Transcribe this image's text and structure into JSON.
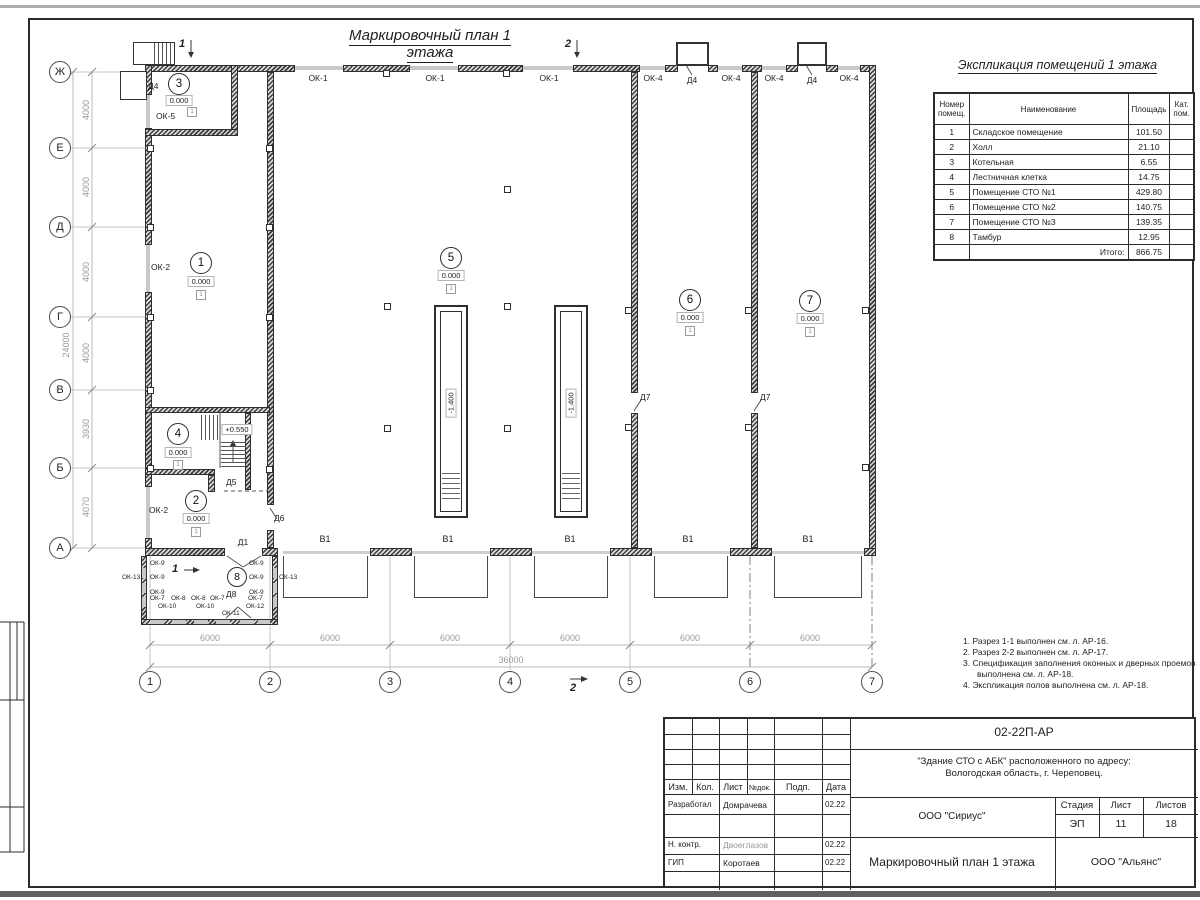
{
  "page": {
    "plan_title": "Маркировочный план 1 этажа",
    "table_title": "Экспликация помещений 1 этажа"
  },
  "table": {
    "col_num": "Номер помещ.",
    "col_name": "Наименование",
    "col_area": "Площадь",
    "col_cat": "Кат. пом.",
    "rows": [
      {
        "num": "1",
        "name": "Складское помещение",
        "area": "101.50"
      },
      {
        "num": "2",
        "name": "Холл",
        "area": "21.10"
      },
      {
        "num": "3",
        "name": "Котельная",
        "area": "6.55"
      },
      {
        "num": "4",
        "name": "Лестничная клетка",
        "area": "14.75"
      },
      {
        "num": "5",
        "name": "Помещение СТО №1",
        "area": "429.80"
      },
      {
        "num": "6",
        "name": "Помещение СТО №2",
        "area": "140.75"
      },
      {
        "num": "7",
        "name": "Помещение СТО №3",
        "area": "139.35"
      },
      {
        "num": "8",
        "name": "Тамбур",
        "area": "12.95"
      }
    ],
    "total_label": "Итого:",
    "total_area": "866.75"
  },
  "notes": {
    "n1": "1. Разрез 1-1 выполнен см. л. АР-16.",
    "n2": "2. Разрез 2-2 выполнен см. л. АР-17.",
    "n3": "3. Спецификация заполнения оконных и дверных проемов выполнена см. л. АР-18.",
    "n4": "4. Экспликация полов выполнена см. л. АР-18."
  },
  "axes": {
    "rows": [
      "Ж",
      "Е",
      "Д",
      "Г",
      "В",
      "Б",
      "А"
    ],
    "cols": [
      "1",
      "2",
      "3",
      "4",
      "5",
      "6",
      "7"
    ],
    "row_dims": [
      "4000",
      "4000",
      "4000",
      "4000",
      "3930",
      "4070"
    ],
    "row_total": "24000",
    "col_dim": "6000",
    "col_total": "36000"
  },
  "sections": {
    "s1": "1",
    "s2": "2"
  },
  "plan": {
    "labels": {
      "ok1": "ОК-1",
      "ok2": "ОК-2",
      "ok4": "ОК-4",
      "ok5": "ОК-5",
      "ok7": "ОК-7",
      "ok8": "ОК-8",
      "ok9": "ОК-9",
      "ok10": "ОК-10",
      "ok11": "ОК-11",
      "ok12": "ОК-12",
      "ok13": "ОК-13",
      "d1": "Д1",
      "d4": "Д4",
      "d5": "Д5",
      "d6": "Д6",
      "d7": "Д7",
      "d8": "Д8",
      "gate": "В1"
    },
    "rooms": {
      "r1": "1",
      "r2": "2",
      "r3": "3",
      "r4": "4",
      "r5": "5",
      "r6": "6",
      "r7": "7",
      "r8": "8"
    },
    "elev_zero": "0.000",
    "elev_stair": "+0.550",
    "elev_pit": "-1.400",
    "floor_mark": "1"
  },
  "titleblock": {
    "doc_number": "02-22П-АР",
    "object_line1": "\"Здание СТО с АБК\" расположенного по адресу:",
    "object_line2": "Вологодская область, г. Череповец.",
    "org": "ООО \"Сириус\"",
    "stage_label": "Стадия",
    "sheet_label": "Лист",
    "sheets_label": "Листов",
    "stage": "ЭП",
    "sheet": "11",
    "sheets": "18",
    "drawing_name": "Маркировочный план 1 этажа",
    "org2": "ООО \"Альянс\"",
    "cols": {
      "izm": "Изм.",
      "kol": "Кол.",
      "list": "Лист",
      "ndok": "№док.",
      "podp": "Подп.",
      "data": "Дата"
    },
    "row1_role": "Разработал",
    "row1_name": "Домрачева",
    "row1_date": "02.22",
    "row2_role": "Н. контр.",
    "row2_name": "Двоеглазов",
    "row2_date": "02.22",
    "row3_role": "ГИП",
    "row3_name": "Коротаев",
    "row3_date": "02.22"
  }
}
